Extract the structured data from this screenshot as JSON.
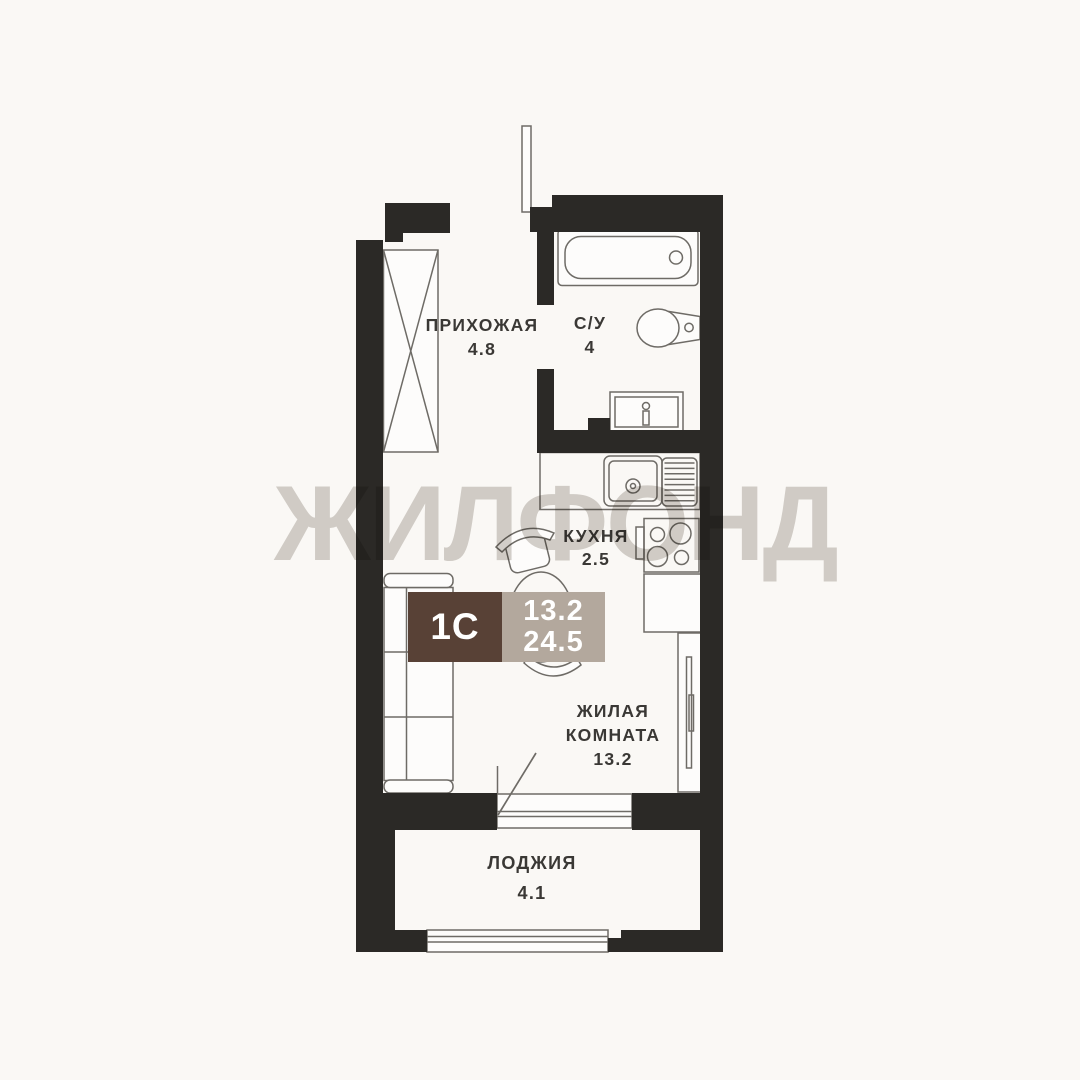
{
  "watermark": {
    "text": "ЖИЛФОНД",
    "color": "#d4d1cd"
  },
  "badge": {
    "type": "1С",
    "area_living": "13.2",
    "area_total": "24.5",
    "brown_color": "#584136",
    "beige_color": "#b3a89d",
    "text_color": "#ffffff"
  },
  "rooms": [
    {
      "id": "hallway",
      "name": "ПРИХОЖАЯ",
      "area": "4.8"
    },
    {
      "id": "bathroom",
      "name": "С/У",
      "area": "4"
    },
    {
      "id": "kitchen",
      "name": "КУХНЯ",
      "area": "2.5"
    },
    {
      "id": "living",
      "name": "ЖИЛАЯ КОМНАТА",
      "area": "13.2"
    },
    {
      "id": "loggia",
      "name": "ЛОДЖИЯ",
      "area": "4.1"
    }
  ],
  "furniture_icons": [
    "entrance-door-icon",
    "wardrobe-icon",
    "bathtub-icon",
    "toilet-icon",
    "bathroom-sink-icon",
    "kitchen-counter-icon",
    "kitchen-sink-icon",
    "stove-icon",
    "base-cabinet-icon",
    "tall-cabinet-icon",
    "dining-table-icon",
    "chair-icon",
    "sofa-icon",
    "balcony-door-icon",
    "balcony-window-icon",
    "loggia-window-icon"
  ],
  "colors": {
    "background": "#faf8f5",
    "wall": "#2b2926",
    "furniture_line": "#6e6b66",
    "furniture_fill": "#fdfcfb",
    "label_text": "#3a3835"
  }
}
